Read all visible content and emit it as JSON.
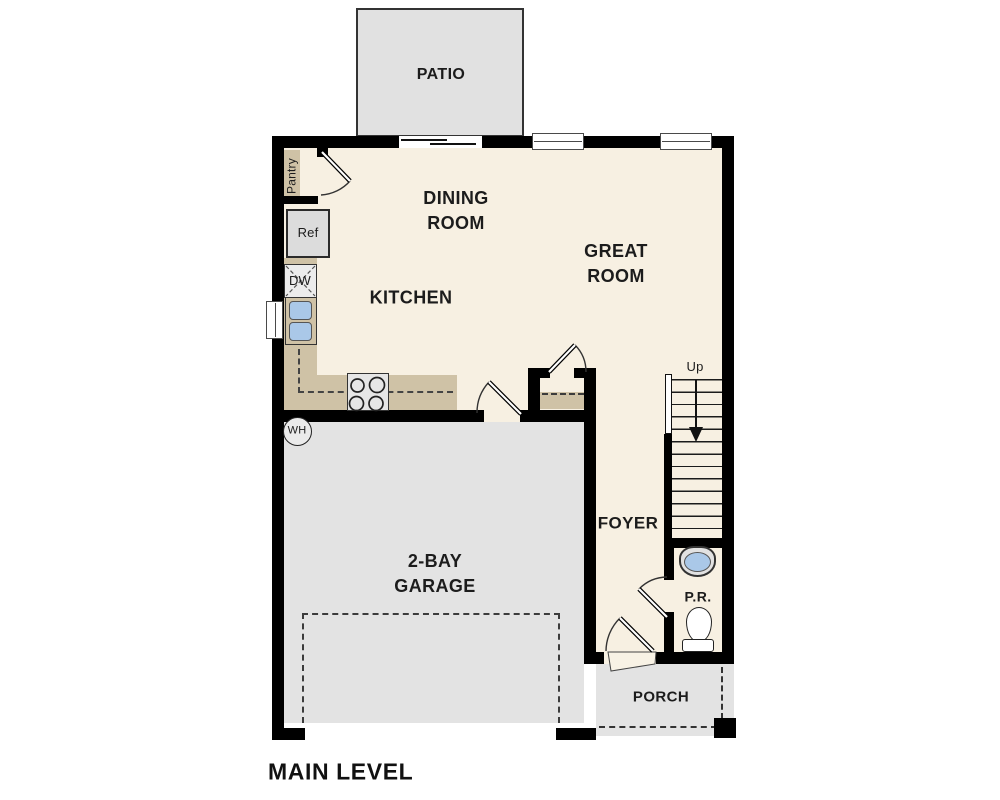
{
  "plan": {
    "title": "MAIN LEVEL",
    "labels": {
      "patio": "PATIO",
      "dining_room": "DINING\nROOM",
      "great_room": "GREAT\nROOM",
      "kitchen": "KITCHEN",
      "pantry": "Pantry",
      "garage": "2-BAY\nGARAGE",
      "foyer": "FOYER",
      "powder_room": "P.R.",
      "porch": "PORCH",
      "ref": "Ref",
      "dishwasher": "DW",
      "water_heater": "WH",
      "stairs_direction": "Up"
    },
    "colors": {
      "floor_cream": "#f7f0e2",
      "surface_gray": "#e3e3e3",
      "patio_gray": "#e1e1e1",
      "counter_tan": "#cfc2a6",
      "fixture_blue": "#aac8e8",
      "wall_black": "#000000",
      "text_dark": "#1c1c1c",
      "window_frame": "#4a4a4a"
    }
  }
}
